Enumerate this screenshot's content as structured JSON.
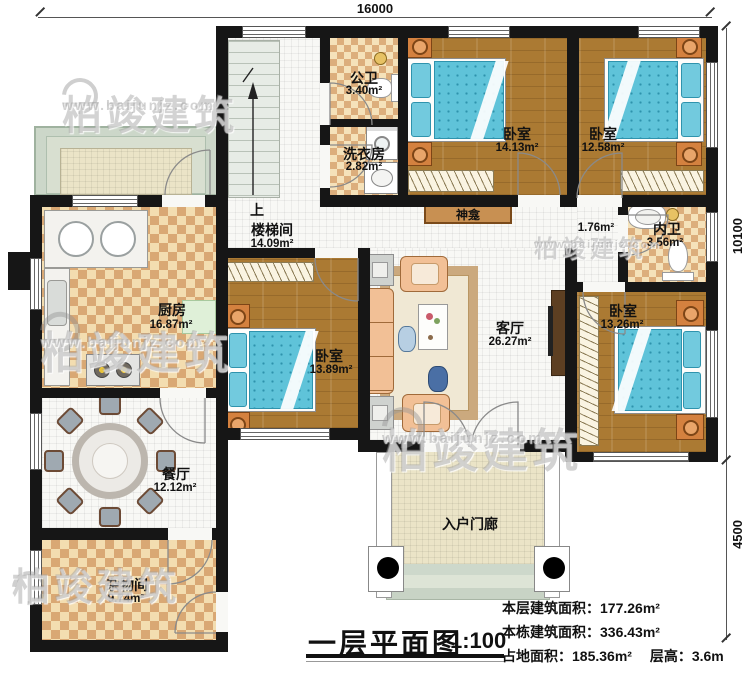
{
  "dimensions": {
    "top": "16000",
    "right_upper": "10100",
    "right_lower": "4500"
  },
  "rooms": [
    {
      "name": "公卫",
      "area": "3.40m²"
    },
    {
      "name": "洗衣房",
      "area": "2.82m²"
    },
    {
      "name": "卧室",
      "area": "14.13m²"
    },
    {
      "name": "卧室",
      "area": "12.58m²"
    },
    {
      "name": "内卫",
      "area": "3.56m²"
    },
    {
      "name": "楼梯间",
      "area": "14.09m²"
    },
    {
      "name": "厨房",
      "area": "16.87m²"
    },
    {
      "name": "卧室",
      "area": "13.89m²"
    },
    {
      "name": "客厅",
      "area": "26.27m²"
    },
    {
      "name": "卧室",
      "area": "13.26m²"
    },
    {
      "name": "餐厅",
      "area": "12.12m²"
    },
    {
      "name": "杂物间",
      "area": "9.74m²"
    },
    {
      "name": "入户门廊"
    }
  ],
  "labels": {
    "up": "上",
    "shrine": "神龛",
    "hall_area": "1.76m²"
  },
  "title": {
    "text": "一层平面图",
    "scale": "1:100"
  },
  "stats": {
    "line1_label": "本层建筑面积：",
    "line1_value": "177.26m²",
    "line2_label": "本栋建筑面积：",
    "line2_value": "336.43m²",
    "line3_label": "占地面积：",
    "line3_value": "185.36m²",
    "line3b_label": "层高：",
    "line3b_value": "3.6m"
  },
  "watermark": {
    "brand": "柏竣建筑",
    "url": "www.baijunjz.com"
  },
  "colors": {
    "wall": "#161616",
    "wood_floor": "#ab7a33",
    "checker_dark": "#d9a874",
    "checker_light": "#f3ddb0",
    "bed_blue": "#5fc3d9",
    "terrace_green": "#ccd7c9",
    "nightstand_orange": "#d4813f"
  }
}
